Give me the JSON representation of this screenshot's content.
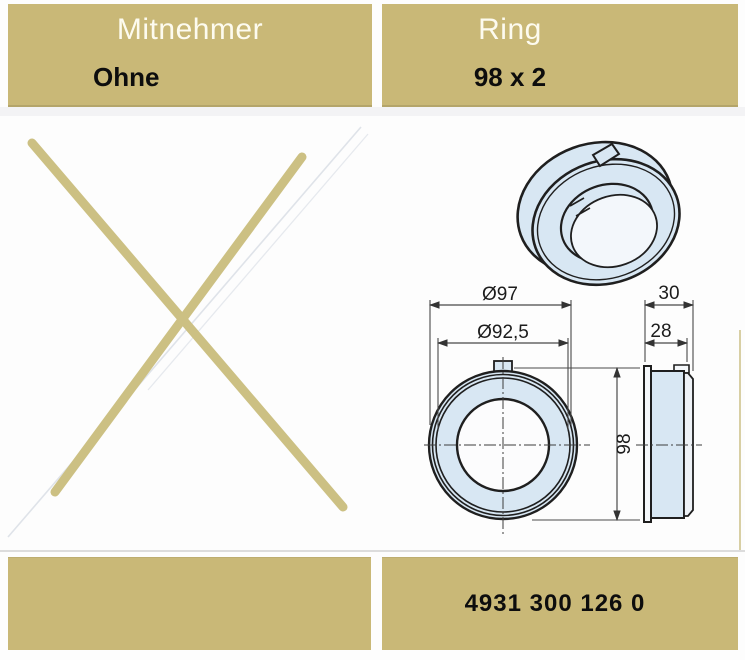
{
  "table": {
    "columns": [
      {
        "header": "Mitnehmer",
        "value": "Ohne"
      },
      {
        "header": "Ring",
        "value": "98 x 2"
      }
    ]
  },
  "left_cell": {
    "marker": "not-available-cross"
  },
  "drawing": {
    "dimensions": {
      "outer_diameter": "Ø97",
      "inner_diameter": "Ø92,5",
      "height": "98",
      "depth_total": "30",
      "depth_body": "28"
    }
  },
  "part_number": "4931 300 126 0",
  "colors": {
    "cell_background": "#c9b877",
    "cross": "#ccc083",
    "drawing_fill": "#d8e7f3",
    "drawing_line": "#1f1f1f"
  }
}
